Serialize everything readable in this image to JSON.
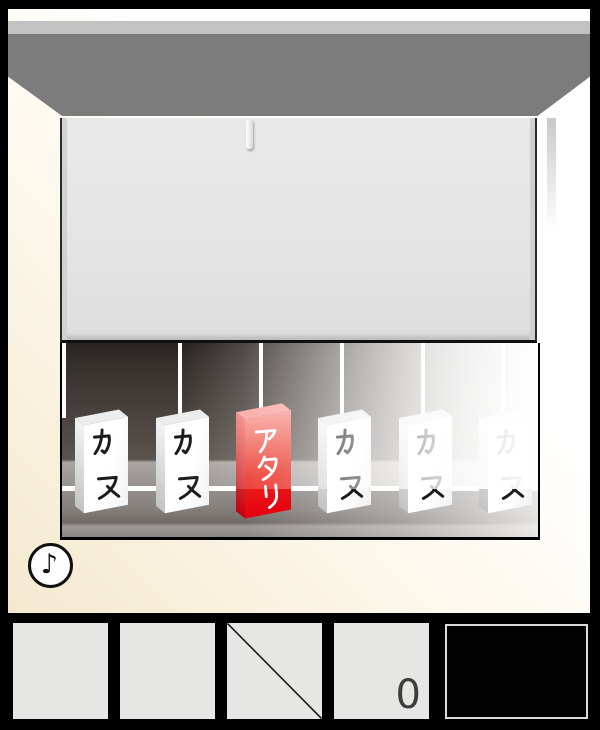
{
  "colors": {
    "atari_red": "#e60012",
    "card_white": "#ffffff",
    "beam_gray": "#7c7c7c",
    "frame_black": "#000000"
  },
  "scene": {
    "cards": [
      {
        "label": "カス",
        "type": "hazure"
      },
      {
        "label": "カス",
        "type": "hazure"
      },
      {
        "label": "アタリ",
        "type": "atari"
      },
      {
        "label": "カス",
        "type": "hazure"
      },
      {
        "label": "カス",
        "type": "hazure"
      },
      {
        "label": "カス",
        "type": "hazure"
      }
    ]
  },
  "sound": {
    "glyph": "♪"
  },
  "toolbar": {
    "counter_value": "0",
    "slots": [
      {
        "state": "empty"
      },
      {
        "state": "empty"
      },
      {
        "state": "crossed"
      },
      {
        "state": "counter"
      },
      {
        "state": "display"
      }
    ]
  }
}
